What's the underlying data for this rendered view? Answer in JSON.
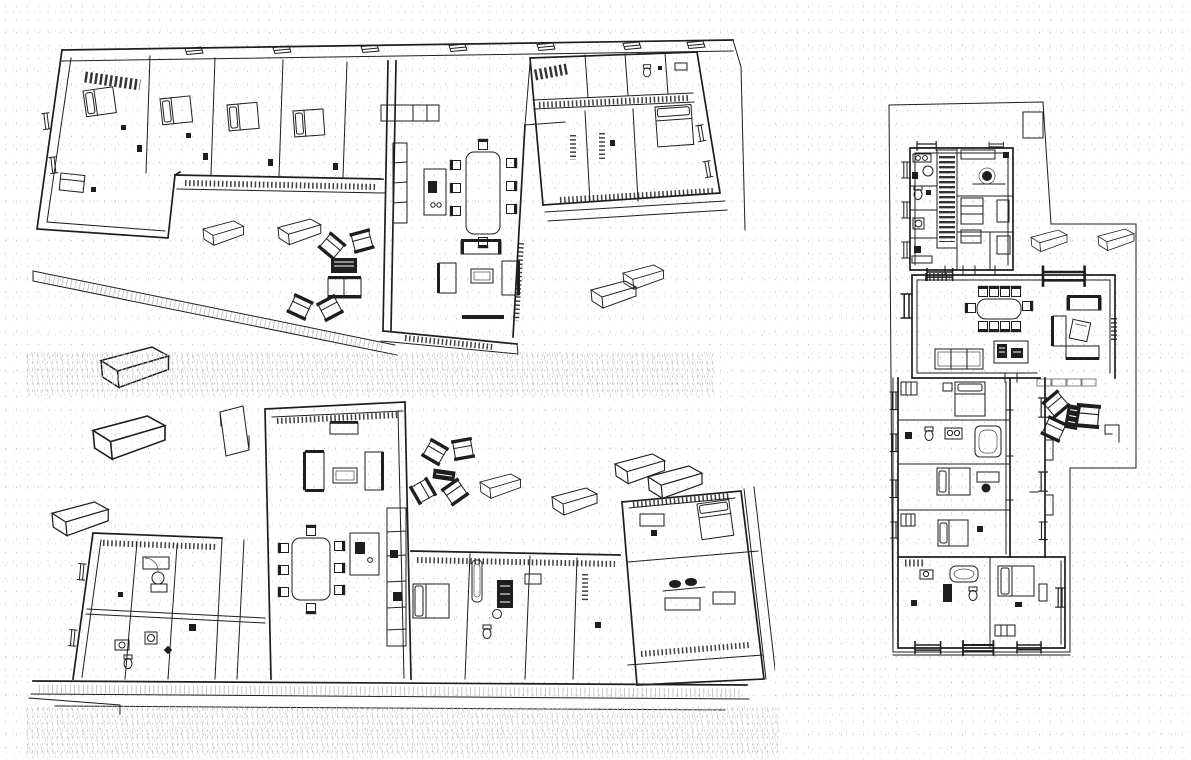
{
  "page": {
    "background": "#ffffff"
  },
  "colors": {
    "ink": "#1e1e1e",
    "paper": "#ffffff",
    "speckle": "#c9c9c9"
  },
  "panels": [
    {
      "name": "axonometric-cutaway-view-upper",
      "view": "3d cutaway floor plan seen from above-north"
    },
    {
      "name": "axonometric-cutaway-view-lower",
      "view": "3d cutaway floor plan seen from above-south"
    },
    {
      "name": "top-down-floor-plan",
      "view": "orthographic plan view"
    }
  ]
}
